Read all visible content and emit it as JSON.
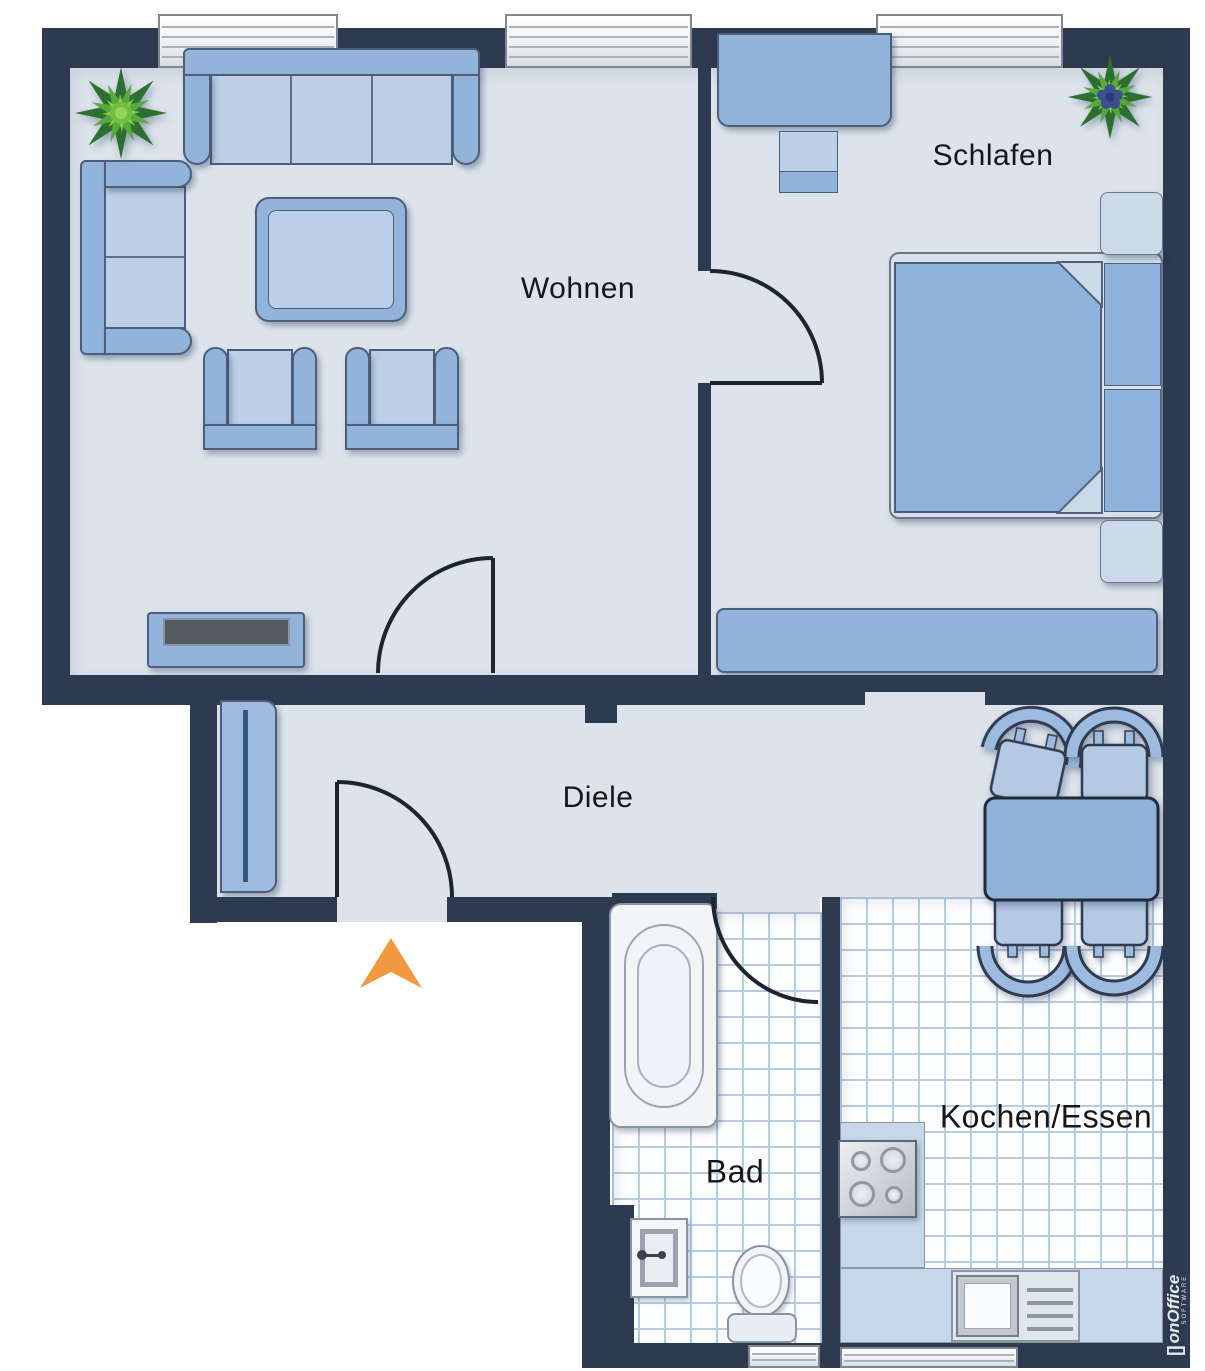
{
  "rooms": {
    "living": "Wohnen",
    "bedroom": "Schlafen",
    "hall": "Diele",
    "bath": "Bad",
    "kitchen": "Kochen/Essen"
  },
  "watermark": {
    "bracket": "[]",
    "brand": "onOffice",
    "sub": "SOFTWARE"
  },
  "palette": {
    "wall": "#2e3a4f",
    "floor": "#dce3eb",
    "furniture": "#92b3da",
    "furniture_light": "#bccfe7",
    "furniture_pale": "#ccd9e9",
    "outline": "#4e5e7a",
    "tile_line": "#b5cde3",
    "tile_bg": "#fdfeff",
    "counter": "#c6d7e9",
    "door_line": "#1c242f",
    "entry_arrow": "#f0993e",
    "plant_green_dark": "#2c7030",
    "plant_green_mid": "#58a83c",
    "plant_green_light": "#8bcb50",
    "plant_berries": "#3c4f92",
    "label": "#161616",
    "watermark_text": "#e4e9f0"
  }
}
